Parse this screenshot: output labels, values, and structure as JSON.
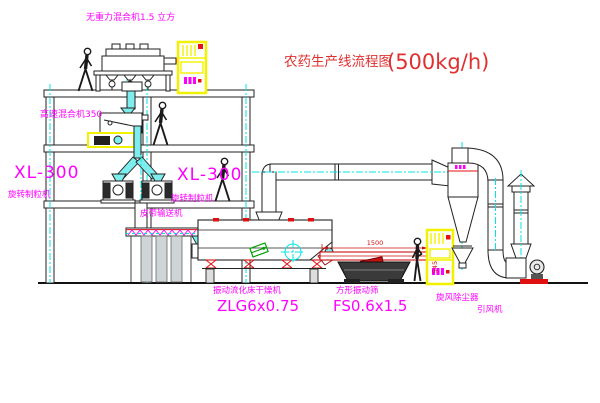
{
  "title": {
    "name": "农药生产线流程图",
    "capacity": "(500kg/h)"
  },
  "labels": {
    "gravity_mixer": "无重力混合机1.5 立方",
    "high_speed_mixer": "高速混合机350",
    "granulator_left": {
      "model": "XL-300",
      "name": "旋转制粒机"
    },
    "granulator_right": {
      "model": "XL-300",
      "name": "旋转制粒机"
    },
    "belt_conveyor": "皮带输送机",
    "dryer": {
      "name": "振动流化床干燥机",
      "model": "ZLG6x0.75"
    },
    "screen": {
      "name": "方形振动筛",
      "model": "FS0.6x1.5"
    },
    "cyclone": "旋风除尘器",
    "fan": "引风机"
  },
  "dimensions": {
    "screen_width": "1500",
    "screen_height": "545"
  },
  "colors": {
    "label_magenta": "#ff00ff",
    "title_red": "#e03030",
    "dimension_red": "#cc1111",
    "cabinet_yellow": "#f2f200",
    "centerline_cyan": "#00e5e5",
    "chute_cyan": "#7deded",
    "symbol_green": "#00a000"
  }
}
